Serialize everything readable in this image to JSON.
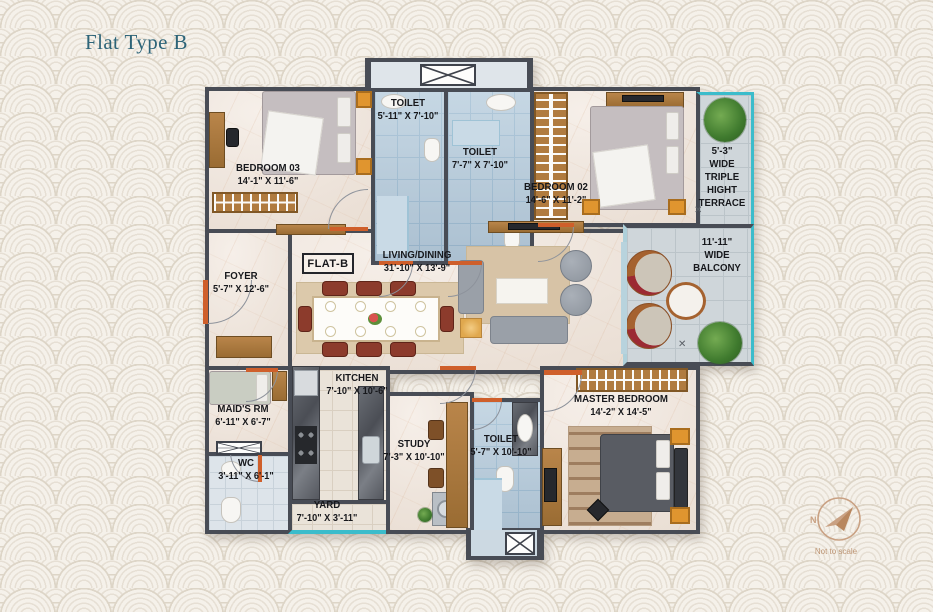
{
  "page": {
    "title": "Flat Type B",
    "compass": {
      "n": "N",
      "note": "Not to scale"
    }
  },
  "plan": {
    "flat_label": "FLAT-B",
    "rooms": {
      "bedroom03": {
        "name": "BEDROOM 03",
        "dims": "14'-1\" X 11'-6\""
      },
      "toilet1": {
        "name": "TOILET",
        "dims": "5'-11\" X 7'-10\""
      },
      "toilet2": {
        "name": "TOILET",
        "dims": "7'-7\" X 7'-10\""
      },
      "bedroom02": {
        "name": "BEDROOM 02",
        "dims": "14'-6\" X 11'-2\""
      },
      "terrace": {
        "name": "5'-3\"\nWIDE\nTRIPLE\nHIGHT\nTERRACE"
      },
      "balcony": {
        "name": "11'-11\"\nWIDE\nBALCONY"
      },
      "foyer": {
        "name": "FOYER",
        "dims": "5'-7\" X 12'-6\""
      },
      "living": {
        "name": "LIVING/DINING",
        "dims": "31'-10\" X 13'-9\""
      },
      "kitchen": {
        "name": "KITCHEN",
        "dims": "7'-10\" X 10'-6\""
      },
      "maids_rm": {
        "name": "MAID'S RM",
        "dims": "6'-11\" X 6'-7\""
      },
      "wc": {
        "name": "WC",
        "dims": "3'-11\" X 6'-1\""
      },
      "yard": {
        "name": "YARD",
        "dims": "7'-10\" X 3'-11\""
      },
      "study": {
        "name": "STUDY",
        "dims": "7'-3\" X 10'-10\""
      },
      "toilet3": {
        "name": "TOILET",
        "dims": "5'-7\" X 10'-10\""
      },
      "master_bedroom": {
        "name": "MASTER BEDROOM",
        "dims": "14'-2\" X 14'-5\""
      }
    },
    "colors": {
      "wall": "#484c55",
      "accent_teal": "#3bbccb",
      "door_orange": "#cf5f2b",
      "wood": "#b07b3f",
      "tile_blue": "#b6ccdc",
      "floor_cream": "#f0e8e1",
      "title_teal": "#2d6478",
      "compass_tan": "#c9a183"
    }
  }
}
